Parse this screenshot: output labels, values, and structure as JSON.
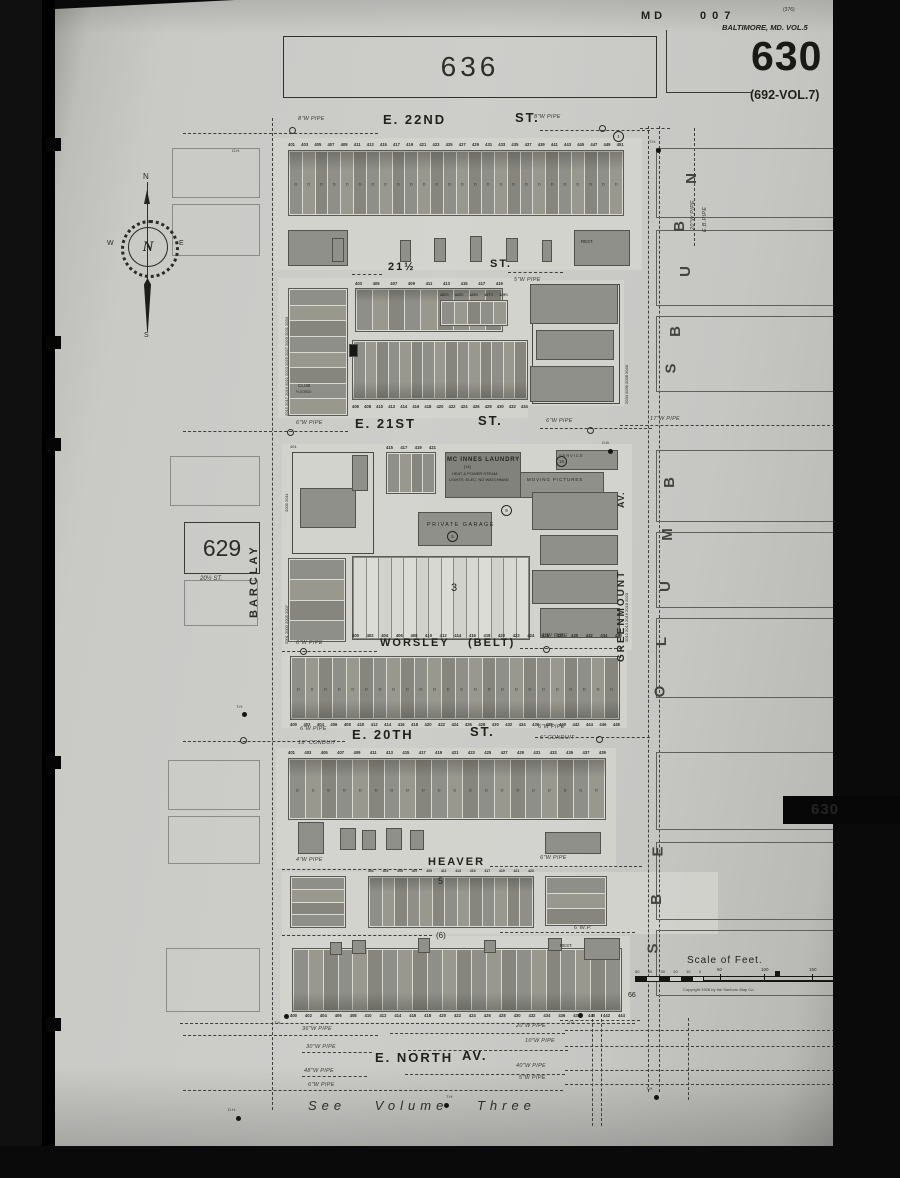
{
  "header": {
    "state": "MD",
    "plate": "007",
    "tiny_no": "(376)",
    "series": "BALTIMORE, MD. VOL.5",
    "sheet": "630",
    "alt_no": "(692-VOL.7)"
  },
  "adjacents": {
    "top": "636",
    "left": "629",
    "left_note": "20½ ST.",
    "bottom_note": "See Volume Three"
  },
  "tab": {
    "text": "630"
  },
  "compass": {
    "n": "N",
    "e": "E",
    "s": "S",
    "w": "W",
    "center": "N"
  },
  "scale": {
    "title": "Scale of Feet.",
    "left_ticks": [
      "50",
      "40",
      "30",
      "20",
      "10",
      "0"
    ],
    "right_ticks": [
      {
        "t": "50",
        "x": 82
      },
      {
        "t": "100",
        "x": 126
      },
      {
        "t": "150",
        "x": 174
      }
    ],
    "copyright": "Copyright 1928 by the Sanborn Map Co."
  },
  "streets": [
    {
      "a": "E. 22ND",
      "b": "ST.",
      "ax": 383,
      "ay": 112,
      "bx": 515,
      "by": 110,
      "s": 13
    },
    {
      "a": "21½",
      "b": "ST.",
      "ax": 388,
      "ay": 261,
      "bx": 490,
      "by": 258,
      "s": 11
    },
    {
      "a": "E. 21ST",
      "b": "ST.",
      "ax": 355,
      "ay": 416,
      "bx": 478,
      "by": 413,
      "s": 13
    },
    {
      "a": "WORSLEY",
      "b": "(BELT)",
      "ax": 380,
      "ay": 637,
      "bx": 468,
      "by": 637,
      "s": 11
    },
    {
      "a": "E. 20TH",
      "b": "ST.",
      "ax": 352,
      "ay": 727,
      "bx": 470,
      "by": 724,
      "s": 13
    },
    {
      "a": "HEAVER",
      "b": "",
      "ax": 428,
      "ay": 856,
      "bx": 0,
      "by": 0,
      "s": 11
    },
    {
      "a": "E. NORTH",
      "b": "AV.",
      "ax": 375,
      "ay": 1050,
      "bx": 462,
      "by": 1048,
      "s": 13
    }
  ],
  "vstreets": [
    {
      "name": "BARCLAY",
      "x": 248,
      "y": 618,
      "s": 11,
      "sp": 3
    },
    {
      "name": "GREENMOUNT",
      "x": 616,
      "y": 662,
      "s": 10,
      "sp": 2
    },
    {
      "name": "AV.",
      "x": 616,
      "y": 508,
      "s": 9,
      "sp": 1
    }
  ],
  "margin_letters": [
    {
      "t": "N",
      "x": 686,
      "y": 170
    },
    {
      "t": "B",
      "x": 674,
      "y": 218
    },
    {
      "t": "U",
      "x": 680,
      "y": 263
    },
    {
      "t": "B",
      "x": 670,
      "y": 323
    },
    {
      "t": "S",
      "x": 666,
      "y": 360
    },
    {
      "t": "B",
      "x": 664,
      "y": 474
    },
    {
      "t": "M",
      "x": 661,
      "y": 526
    },
    {
      "t": "U",
      "x": 660,
      "y": 578
    },
    {
      "t": "L",
      "x": 657,
      "y": 633
    },
    {
      "t": "O",
      "x": 654,
      "y": 683
    },
    {
      "t": "E",
      "x": 653,
      "y": 843
    },
    {
      "t": "B",
      "x": 651,
      "y": 891
    },
    {
      "t": "S",
      "x": 648,
      "y": 940
    }
  ],
  "right_boxes": [
    {
      "y": 148,
      "h": 70
    },
    {
      "y": 230,
      "h": 76
    },
    {
      "y": 316,
      "h": 76
    },
    {
      "y": 450,
      "h": 72
    },
    {
      "y": 532,
      "h": 76
    },
    {
      "y": 618,
      "h": 80
    },
    {
      "y": 752,
      "h": 78
    },
    {
      "y": 842,
      "h": 78
    },
    {
      "y": 930,
      "h": 66
    }
  ],
  "left_boxes": [
    {
      "x": 172,
      "y": 148,
      "w": 88,
      "h": 50
    },
    {
      "x": 172,
      "y": 204,
      "w": 88,
      "h": 52
    },
    {
      "x": 170,
      "y": 456,
      "w": 90,
      "h": 50
    },
    {
      "x": 184,
      "y": 580,
      "w": 74,
      "h": 46
    },
    {
      "x": 168,
      "y": 760,
      "w": 92,
      "h": 50
    },
    {
      "x": 168,
      "y": 816,
      "w": 92,
      "h": 48
    },
    {
      "x": 166,
      "y": 948,
      "w": 94,
      "h": 64
    }
  ],
  "slips": [
    {
      "x": 274,
      "y": 138,
      "w": 368,
      "h": 132
    },
    {
      "x": 278,
      "y": 278,
      "w": 250,
      "h": 140
    },
    {
      "x": 528,
      "y": 280,
      "w": 96,
      "h": 126
    },
    {
      "x": 282,
      "y": 444,
      "w": 350,
      "h": 206
    },
    {
      "x": 282,
      "y": 650,
      "w": 345,
      "h": 78
    },
    {
      "x": 276,
      "y": 748,
      "w": 340,
      "h": 120
    },
    {
      "x": 282,
      "y": 872,
      "w": 436,
      "h": 62
    },
    {
      "x": 280,
      "y": 936,
      "w": 350,
      "h": 86
    }
  ],
  "blocks": [
    {
      "x": 288,
      "y": 150,
      "w": 336,
      "h": 66,
      "cells": 26,
      "letter": "D",
      "band": "top"
    },
    {
      "x": 355,
      "y": 288,
      "w": 148,
      "h": 44,
      "cells": 9,
      "band": "top"
    },
    {
      "x": 440,
      "y": 300,
      "w": 68,
      "h": 26,
      "cells": 5
    },
    {
      "x": 288,
      "y": 288,
      "w": 60,
      "h": 128,
      "cells": 8,
      "dir": "col"
    },
    {
      "x": 352,
      "y": 340,
      "w": 176,
      "h": 60,
      "cells": 15,
      "band": "bottom"
    },
    {
      "x": 386,
      "y": 452,
      "w": 50,
      "h": 42,
      "cells": 4
    },
    {
      "x": 352,
      "y": 556,
      "w": 178,
      "h": 84,
      "cells": 14,
      "white": true
    },
    {
      "x": 288,
      "y": 558,
      "w": 58,
      "h": 84,
      "cells": 4,
      "dir": "col"
    },
    {
      "x": 290,
      "y": 656,
      "w": 330,
      "h": 64,
      "cells": 24,
      "letter": "D",
      "band": "bottom"
    },
    {
      "x": 288,
      "y": 758,
      "w": 318,
      "h": 62,
      "cells": 20,
      "letter": "D",
      "band": "top"
    },
    {
      "x": 290,
      "y": 876,
      "w": 56,
      "h": 52,
      "cells": 4,
      "dir": "col"
    },
    {
      "x": 368,
      "y": 876,
      "w": 166,
      "h": 52,
      "cells": 13,
      "band": "top"
    },
    {
      "x": 545,
      "y": 876,
      "w": 62,
      "h": 50,
      "cells": 3,
      "dir": "col"
    },
    {
      "x": 292,
      "y": 948,
      "w": 330,
      "h": 64,
      "cells": 22,
      "band": "bottom"
    }
  ],
  "small_bldgs": [
    {
      "x": 288,
      "y": 230,
      "w": 60,
      "h": 36
    },
    {
      "x": 574,
      "y": 230,
      "w": 56,
      "h": 36
    },
    {
      "x": 332,
      "y": 238,
      "w": 12,
      "h": 24
    },
    {
      "x": 400,
      "y": 240,
      "w": 11,
      "h": 22
    },
    {
      "x": 434,
      "y": 238,
      "w": 12,
      "h": 24
    },
    {
      "x": 470,
      "y": 236,
      "w": 12,
      "h": 26
    },
    {
      "x": 506,
      "y": 238,
      "w": 12,
      "h": 24
    },
    {
      "x": 542,
      "y": 240,
      "w": 10,
      "h": 22
    },
    {
      "x": 530,
      "y": 284,
      "w": 88,
      "h": 40
    },
    {
      "x": 536,
      "y": 330,
      "w": 78,
      "h": 30
    },
    {
      "x": 530,
      "y": 366,
      "w": 84,
      "h": 36
    },
    {
      "x": 349,
      "y": 344,
      "w": 9,
      "h": 13,
      "f": "#161614"
    },
    {
      "x": 300,
      "y": 488,
      "w": 56,
      "h": 40
    },
    {
      "x": 352,
      "y": 455,
      "w": 16,
      "h": 36
    },
    {
      "x": 445,
      "y": 452,
      "w": 76,
      "h": 46,
      "f": "#82827c"
    },
    {
      "x": 556,
      "y": 450,
      "w": 62,
      "h": 20
    },
    {
      "x": 520,
      "y": 472,
      "w": 84,
      "h": 26
    },
    {
      "x": 418,
      "y": 512,
      "w": 74,
      "h": 34
    },
    {
      "x": 532,
      "y": 492,
      "w": 86,
      "h": 38
    },
    {
      "x": 540,
      "y": 535,
      "w": 78,
      "h": 30
    },
    {
      "x": 532,
      "y": 570,
      "w": 86,
      "h": 34
    },
    {
      "x": 540,
      "y": 608,
      "w": 80,
      "h": 30
    },
    {
      "x": 298,
      "y": 822,
      "w": 26,
      "h": 32
    },
    {
      "x": 340,
      "y": 828,
      "w": 16,
      "h": 22
    },
    {
      "x": 362,
      "y": 830,
      "w": 14,
      "h": 20
    },
    {
      "x": 386,
      "y": 828,
      "w": 16,
      "h": 22
    },
    {
      "x": 410,
      "y": 830,
      "w": 14,
      "h": 20
    },
    {
      "x": 545,
      "y": 832,
      "w": 56,
      "h": 22
    },
    {
      "x": 330,
      "y": 942,
      "w": 12,
      "h": 13
    },
    {
      "x": 352,
      "y": 940,
      "w": 14,
      "h": 14
    },
    {
      "x": 418,
      "y": 938,
      "w": 12,
      "h": 15
    },
    {
      "x": 484,
      "y": 940,
      "w": 12,
      "h": 13
    },
    {
      "x": 548,
      "y": 938,
      "w": 14,
      "h": 13
    },
    {
      "x": 584,
      "y": 938,
      "w": 36,
      "h": 22
    }
  ],
  "outlines": [
    {
      "x": 292,
      "y": 452,
      "w": 82,
      "h": 102
    },
    {
      "x": 532,
      "y": 284,
      "w": 88,
      "h": 120
    }
  ],
  "number_strips": [
    {
      "x": 288,
      "y": 142,
      "w": 336,
      "s": 4.2,
      "items": [
        "401",
        "403",
        "405",
        "407",
        "409",
        "411",
        "413",
        "415",
        "417",
        "419",
        "421",
        "423",
        "425",
        "427",
        "429",
        "431",
        "433",
        "435",
        "437",
        "439",
        "441",
        "443",
        "445",
        "447",
        "449",
        "451"
      ]
    },
    {
      "x": 355,
      "y": 281,
      "w": 148,
      "s": 4.2,
      "items": [
        "403",
        "405",
        "407",
        "409",
        "411",
        "413",
        "415",
        "417",
        "419"
      ]
    },
    {
      "x": 440,
      "y": 293,
      "w": 68,
      "s": 3.5,
      "items": [
        "421½",
        "423½",
        "425½",
        "427½",
        "429½"
      ]
    },
    {
      "x": 352,
      "y": 404,
      "w": 176,
      "s": 4.2,
      "items": [
        "406",
        "408",
        "410",
        "412",
        "414",
        "416",
        "418",
        "420",
        "422",
        "424",
        "426",
        "428",
        "430",
        "432",
        "434"
      ]
    },
    {
      "x": 386,
      "y": 445,
      "w": 50,
      "s": 4.2,
      "items": [
        "415",
        "417",
        "419",
        "421"
      ]
    },
    {
      "x": 352,
      "y": 633,
      "w": 270,
      "s": 4.2,
      "items": [
        "400",
        "402",
        "404",
        "406",
        "408",
        "410",
        "412",
        "414",
        "416",
        "418",
        "420",
        "422",
        "424",
        "426",
        "428",
        "430",
        "432",
        "434",
        "436"
      ]
    },
    {
      "x": 290,
      "y": 722,
      "w": 330,
      "s": 4.2,
      "items": [
        "400",
        "402",
        "404",
        "406",
        "408",
        "410",
        "412",
        "414",
        "416",
        "418",
        "420",
        "422",
        "424",
        "426",
        "428",
        "430",
        "432",
        "434",
        "436",
        "438",
        "440",
        "442",
        "444",
        "446",
        "448"
      ]
    },
    {
      "x": 288,
      "y": 750,
      "w": 318,
      "s": 4.2,
      "items": [
        "401",
        "403",
        "405",
        "407",
        "409",
        "411",
        "413",
        "415",
        "417",
        "419",
        "421",
        "423",
        "425",
        "427",
        "429",
        "431",
        "433",
        "435",
        "437",
        "439"
      ]
    },
    {
      "x": 368,
      "y": 869,
      "w": 166,
      "s": 3.5,
      "items": [
        "401",
        "403",
        "405",
        "407",
        "409",
        "411",
        "413",
        "415",
        "417",
        "419",
        "421",
        "423"
      ]
    },
    {
      "x": 290,
      "y": 1013,
      "w": 335,
      "s": 4.2,
      "items": [
        "400",
        "402",
        "404",
        "406",
        "408",
        "410",
        "412",
        "414",
        "416",
        "418",
        "420",
        "422",
        "424",
        "426",
        "428",
        "430",
        "432",
        "434",
        "436",
        "438",
        "440",
        "442",
        "444"
      ]
    }
  ],
  "labels": [
    {
      "t": "MC INNES LAUNDRY",
      "x": 447,
      "y": 457,
      "s": 6,
      "b": true,
      "sp": 0.8
    },
    {
      "t": "HEAT & POWER STEAM:",
      "x": 452,
      "y": 471,
      "s": 4
    },
    {
      "t": "LIGHTS: ELEC. NO WATCHMAN",
      "x": 449,
      "y": 477,
      "s": 4
    },
    {
      "t": "[14]",
      "x": 464,
      "y": 464,
      "s": 4
    },
    {
      "t": "SERVICE",
      "x": 559,
      "y": 453,
      "s": 4,
      "sp": 1
    },
    {
      "t": "MOVING PICTURES",
      "x": 527,
      "y": 477,
      "s": 4.4,
      "sp": 1
    },
    {
      "t": "PRIVATE GARAGE",
      "x": 427,
      "y": 522,
      "s": 5.4,
      "sp": 1.5
    },
    {
      "t": "CLUB",
      "x": 298,
      "y": 383,
      "s": 4.6
    },
    {
      "t": "FLOORED",
      "x": 296,
      "y": 390,
      "s": 3.2
    },
    {
      "t": "REST.",
      "x": 581,
      "y": 239,
      "s": 4.4
    },
    {
      "t": "REST.",
      "x": 560,
      "y": 943,
      "s": 4.4
    },
    {
      "t": "3",
      "x": 451,
      "y": 582,
      "s": 11
    },
    {
      "t": "5",
      "x": 438,
      "y": 876,
      "s": 9
    },
    {
      "t": "(6)",
      "x": 436,
      "y": 931,
      "s": 8
    },
    {
      "t": "66",
      "x": 628,
      "y": 992,
      "s": 7
    },
    {
      "t": "O.H.",
      "x": 232,
      "y": 148,
      "s": 4
    },
    {
      "t": "401",
      "x": 290,
      "y": 444,
      "s": 4
    },
    {
      "t": "2015 2017 2019 2021 2023 2025 2027 2029 2031 2033",
      "x": 284,
      "y": 416,
      "s": 4,
      "rot": -90
    },
    {
      "t": "2009 2011",
      "x": 284,
      "y": 512,
      "s": 4,
      "rot": -90
    },
    {
      "t": "2001 2003 2005 2007",
      "x": 284,
      "y": 644,
      "s": 4,
      "rot": -90
    },
    {
      "t": "2034 2036 2038 2040",
      "x": 624,
      "y": 404,
      "s": 4,
      "rot": -90
    },
    {
      "t": "2012 2014 2016 2018 2020",
      "x": 624,
      "y": 642,
      "s": 4,
      "rot": -90
    }
  ],
  "pipe_labels": [
    {
      "t": "8\"W PIPE",
      "x": 298,
      "y": 116
    },
    {
      "t": "8\"W PIPE",
      "x": 534,
      "y": 114
    },
    {
      "t": "5\"W PIPE",
      "x": 514,
      "y": 277
    },
    {
      "t": "6\"W PIPE",
      "x": 296,
      "y": 420
    },
    {
      "t": "6\"W PIPE",
      "x": 546,
      "y": 418
    },
    {
      "t": "17\"W PIPE",
      "x": 650,
      "y": 416
    },
    {
      "t": "6\"W PIPE",
      "x": 296,
      "y": 640
    },
    {
      "t": "4\"W PIPE",
      "x": 541,
      "y": 633
    },
    {
      "t": "6\"W PIPE",
      "x": 300,
      "y": 726
    },
    {
      "t": "16\" CONDUIT",
      "x": 298,
      "y": 740
    },
    {
      "t": "6\"W PIPE",
      "x": 538,
      "y": 724
    },
    {
      "t": "6\" CONDUIT",
      "x": 540,
      "y": 735
    },
    {
      "t": "4\"W PIPE",
      "x": 296,
      "y": 857
    },
    {
      "t": "6\"W PIPE",
      "x": 540,
      "y": 855
    },
    {
      "t": "6\"W.P.",
      "x": 574,
      "y": 925
    },
    {
      "t": "36\"W PIPE",
      "x": 302,
      "y": 1026
    },
    {
      "t": "20\"W PIPE",
      "x": 516,
      "y": 1023
    },
    {
      "t": "30\"W PIPE",
      "x": 306,
      "y": 1044
    },
    {
      "t": "10\"W PIPE",
      "x": 525,
      "y": 1038
    },
    {
      "t": "48\"W PIPE",
      "x": 304,
      "y": 1068
    },
    {
      "t": "40\"W PIPE",
      "x": 516,
      "y": 1063
    },
    {
      "t": "6\"W PIPE",
      "x": 308,
      "y": 1082
    },
    {
      "t": "5\"W PIPE",
      "x": 519,
      "y": 1075
    },
    {
      "t": "20\"W PIPE",
      "x": 690,
      "y": 230,
      "rot": -90
    },
    {
      "t": "E.B.PIPE",
      "x": 702,
      "y": 232,
      "rot": -90
    }
  ],
  "markers": [
    {
      "t": "T.H.",
      "x": 649,
      "y": 139,
      "dx": 656,
      "dy": 148
    },
    {
      "t": "D.B.",
      "x": 602,
      "y": 440,
      "dx": 608,
      "dy": 449
    },
    {
      "t": "T.H.",
      "x": 236,
      "y": 704,
      "dx": 242,
      "dy": 712
    },
    {
      "t": "T.H.",
      "x": 274,
      "y": 1020,
      "dx": 284,
      "dy": 1014
    },
    {
      "t": "T.H.",
      "x": 568,
      "y": 1020,
      "dx": 578,
      "dy": 1013
    },
    {
      "t": "D.H.",
      "x": 228,
      "y": 1107,
      "dx": 236,
      "dy": 1116
    },
    {
      "t": "T.H.",
      "x": 446,
      "y": 1094,
      "dx": 444,
      "dy": 1103
    },
    {
      "t": "T.H.",
      "x": 646,
      "y": 1086,
      "dx": 654,
      "dy": 1095
    }
  ],
  "rings": [
    {
      "x": 289,
      "y": 127
    },
    {
      "x": 599,
      "y": 125
    },
    {
      "x": 287,
      "y": 429
    },
    {
      "x": 587,
      "y": 427
    },
    {
      "x": 300,
      "y": 648
    },
    {
      "x": 543,
      "y": 646
    },
    {
      "x": 240,
      "y": 737
    },
    {
      "x": 596,
      "y": 736
    }
  ],
  "circled": [
    {
      "t": "1",
      "x": 613,
      "y": 131
    },
    {
      "t": "15",
      "x": 556,
      "y": 456
    },
    {
      "t": "9",
      "x": 501,
      "y": 505
    },
    {
      "t": "5",
      "x": 447,
      "y": 531
    }
  ],
  "hdash": [
    {
      "x": 183,
      "y": 133,
      "w": 195
    },
    {
      "x": 540,
      "y": 130,
      "w": 110
    },
    {
      "x": 640,
      "y": 128,
      "w": 30
    },
    {
      "x": 352,
      "y": 274,
      "w": 30
    },
    {
      "x": 508,
      "y": 272,
      "w": 55
    },
    {
      "x": 183,
      "y": 431,
      "w": 165
    },
    {
      "x": 540,
      "y": 428,
      "w": 112
    },
    {
      "x": 620,
      "y": 425,
      "w": 215
    },
    {
      "x": 282,
      "y": 651,
      "w": 95
    },
    {
      "x": 520,
      "y": 648,
      "w": 102
    },
    {
      "x": 183,
      "y": 741,
      "w": 162
    },
    {
      "x": 535,
      "y": 737,
      "w": 115
    },
    {
      "x": 282,
      "y": 869,
      "w": 140
    },
    {
      "x": 490,
      "y": 866,
      "w": 152
    },
    {
      "x": 282,
      "y": 935,
      "w": 150
    },
    {
      "x": 500,
      "y": 932,
      "w": 135
    },
    {
      "x": 180,
      "y": 1023,
      "w": 455
    },
    {
      "x": 560,
      "y": 1020,
      "w": 80
    },
    {
      "x": 183,
      "y": 1035,
      "w": 195
    },
    {
      "x": 390,
      "y": 1033,
      "w": 175
    },
    {
      "x": 565,
      "y": 1030,
      "w": 270
    },
    {
      "x": 302,
      "y": 1052,
      "w": 70
    },
    {
      "x": 408,
      "y": 1050,
      "w": 160
    },
    {
      "x": 565,
      "y": 1046,
      "w": 270
    },
    {
      "x": 302,
      "y": 1076,
      "w": 65
    },
    {
      "x": 405,
      "y": 1074,
      "w": 160
    },
    {
      "x": 565,
      "y": 1070,
      "w": 270
    },
    {
      "x": 183,
      "y": 1090,
      "w": 380
    },
    {
      "x": 565,
      "y": 1084,
      "w": 270
    }
  ],
  "vdash": [
    {
      "x": 272,
      "y": 118,
      "h": 992
    },
    {
      "x": 648,
      "y": 126,
      "h": 966
    },
    {
      "x": 659,
      "y": 126,
      "h": 966
    },
    {
      "x": 694,
      "y": 128,
      "h": 118
    },
    {
      "x": 592,
      "y": 1014,
      "h": 112
    },
    {
      "x": 601,
      "y": 1014,
      "h": 112
    },
    {
      "x": 688,
      "y": 1018,
      "h": 82
    }
  ],
  "holes_y": [
    138,
    336,
    438,
    756,
    1018
  ]
}
